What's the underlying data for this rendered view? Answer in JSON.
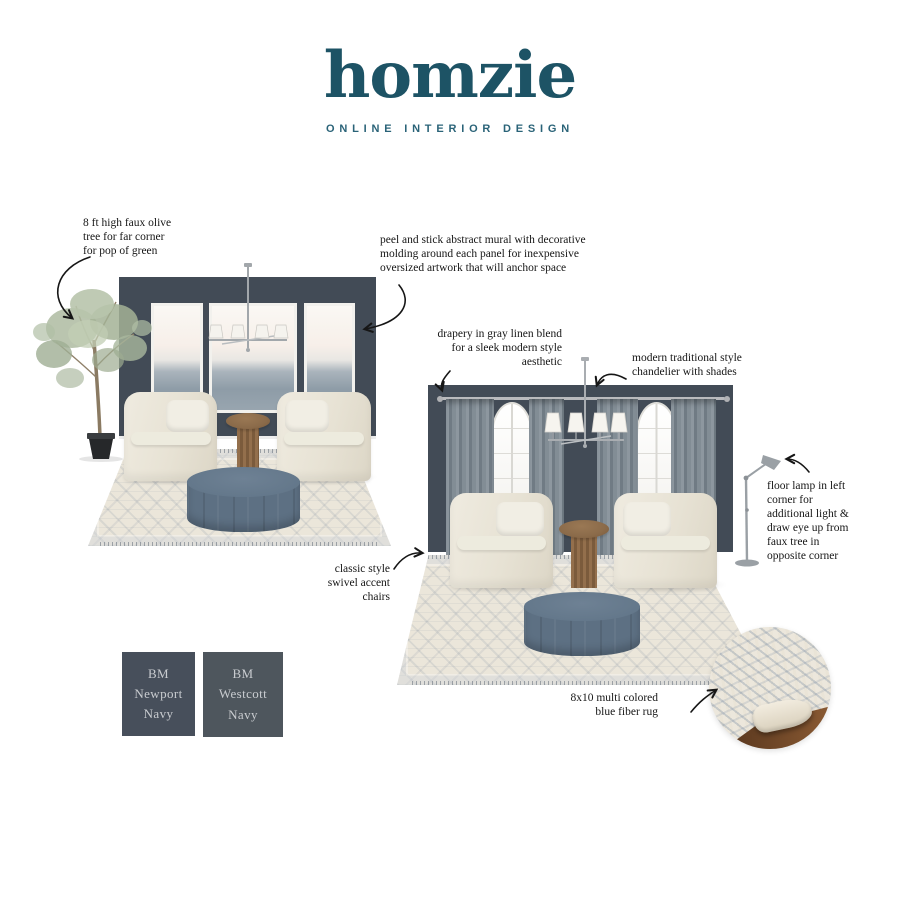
{
  "brand": {
    "name": "homzie",
    "tagline": "ONLINE INTERIOR DESIGN"
  },
  "annotations": {
    "olive_tree": "8 ft high faux olive\ntree for far corner\nfor pop of green",
    "mural": "peel and stick abstract mural with decorative\nmolding around each panel  for inexpensive\noversized artwork that will anchor space",
    "drapery": "drapery in gray linen blend\nfor a sleek modern style\naesthetic",
    "chandelier": "modern traditional style\nchandelier with shades",
    "floor_lamp": "floor lamp in left\ncorner for\nadditional light &\ndraw eye up from\nfaux tree in\nopposite corner",
    "chairs": "classic style\nswivel accent\nchairs",
    "rug": "8x10 multi colored\nblue fiber rug"
  },
  "swatches": [
    {
      "label": "BM\nNewport\nNavy",
      "color": "#474f5b"
    },
    {
      "label": "BM\nWestcott\nNavy",
      "color": "#4e565d"
    }
  ],
  "scene_items": [
    "olive-tree",
    "abstract-mural-panels",
    "chandelier-with-shades",
    "swivel-accent-chairs",
    "fluted-pedestal-table",
    "round-ottoman",
    "patterned-area-rug",
    "gray-linen-drapery",
    "arched-windows",
    "floor-lamp",
    "rug-detail-photo"
  ],
  "colors": {
    "brand_teal": "#1d5365",
    "wall_navy": "#424b56",
    "curtain_gray": "#7d8890",
    "chair_cream": "#e8e4d6",
    "ottoman_blue": "#5d7083",
    "rug_cream": "#ebe6da",
    "rug_blue": "#8b9bb0",
    "wood_brown": "#8b6b4a",
    "metal_silver": "#a2a7ab",
    "swatch_newport": "#474f5b",
    "swatch_westcott": "#4e565d"
  }
}
